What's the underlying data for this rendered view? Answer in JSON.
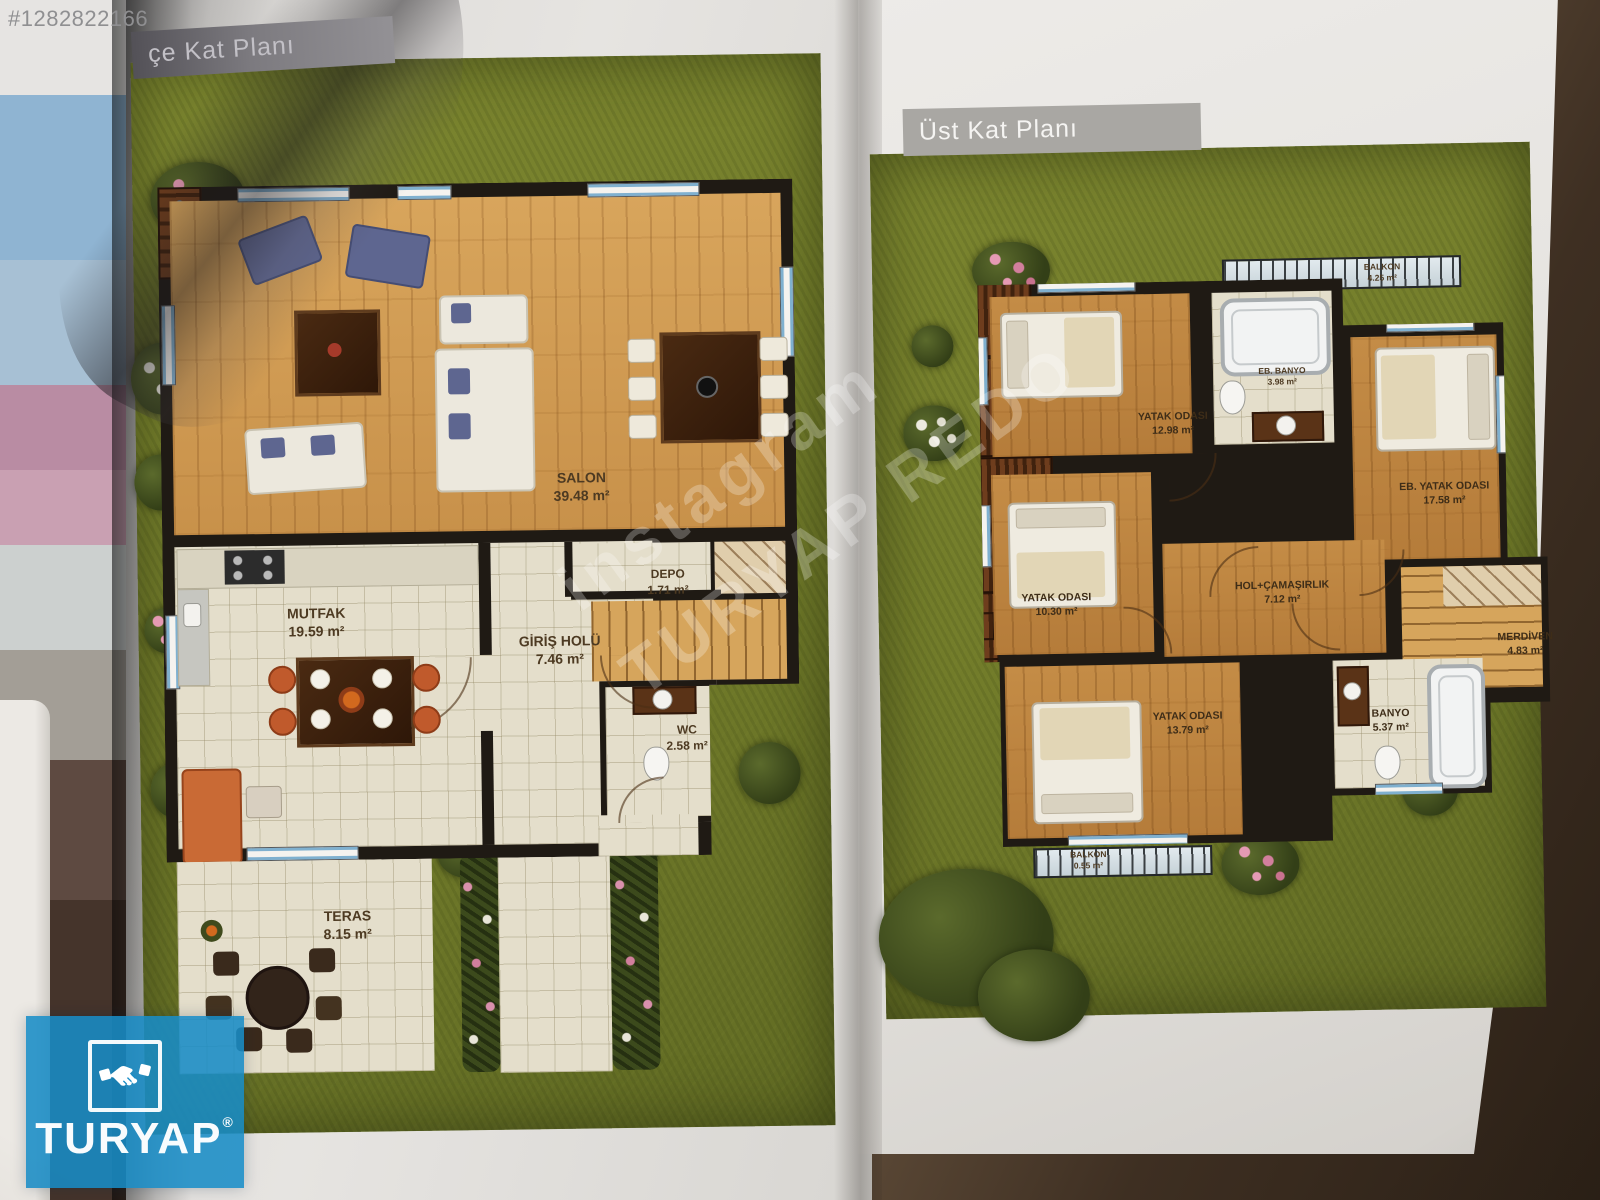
{
  "photo": {
    "listing_id": "#1282822166"
  },
  "pages": {
    "left_plan": {
      "title": "çe Kat Planı",
      "rooms": [
        {
          "name": "SALON",
          "area": "39.48 m²"
        },
        {
          "name": "MUTFAK",
          "area": "19.59 m²"
        },
        {
          "name": "DEPO",
          "area": "1.71 m²"
        },
        {
          "name": "GİRİŞ HOLÜ",
          "area": "7.46 m²"
        },
        {
          "name": "WC",
          "area": "2.58 m²"
        },
        {
          "name": "TERAS",
          "area": "8.15 m²"
        }
      ]
    },
    "right_plan": {
      "title": "Üst Kat Planı",
      "rooms": [
        {
          "name": "BALKON",
          "area": "4.25 m²"
        },
        {
          "name": "YATAK ODASI",
          "area": "12.98 m²"
        },
        {
          "name": "EB. BANYO",
          "area": "3.98 m²"
        },
        {
          "name": "EB. YATAK ODASI",
          "area": "17.58 m²"
        },
        {
          "name": "YATAK ODASI",
          "area": "10.30 m²"
        },
        {
          "name": "HOL+ÇAMAŞIRLIK",
          "area": "7.12 m²"
        },
        {
          "name": "MERDİVEN",
          "area": "4.83 m²"
        },
        {
          "name": "YATAK ODASI",
          "area": "13.79 m²"
        },
        {
          "name": "BANYO",
          "area": "5.37 m²"
        },
        {
          "name": "BALKON",
          "area": "0.55 m²"
        }
      ]
    }
  },
  "watermark": {
    "line1": "instagram",
    "line2": "TURYAP REDO"
  },
  "brand": {
    "name": "TURYAP",
    "registered": "®"
  },
  "colors": {
    "logo_blue": "#188cc6",
    "lawn_green": "#77812f",
    "banner_gray": "#a9a7a3",
    "wood": "#d8a55c",
    "tile": "#e4decb",
    "wall_black": "#1f1a14"
  }
}
